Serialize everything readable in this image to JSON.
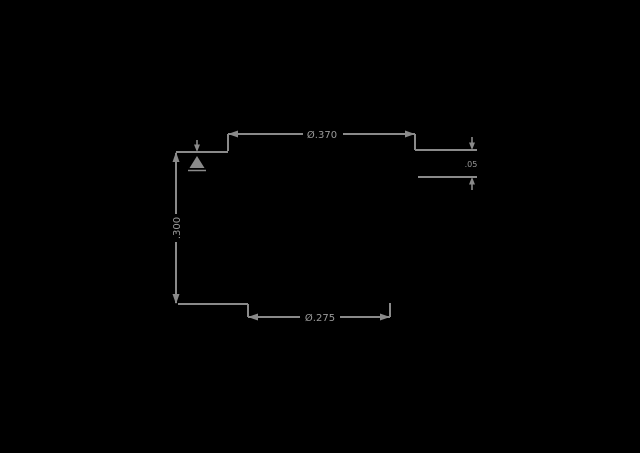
{
  "window": {
    "background_color": "#000000"
  },
  "drawing": {
    "type": "technical-dimension-drawing",
    "stroke_color": "#8a8a8a",
    "text_color": "#9a9a9a",
    "dimensions": {
      "top_diameter": "Ø.370",
      "bottom_diameter": "Ø.275",
      "left_height": ".300",
      "right_thickness": ".05"
    },
    "symbols": {
      "leader_arrow": "down-arrow-icon",
      "surface_mark": "datum-triangle-icon"
    }
  }
}
